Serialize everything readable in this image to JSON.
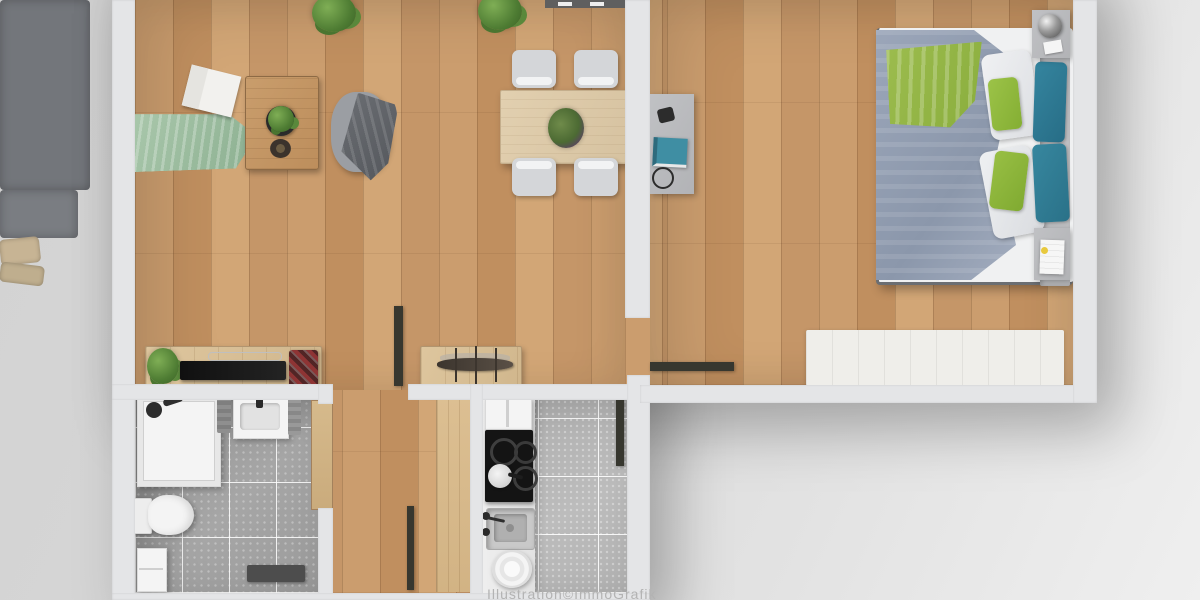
{
  "meta": {
    "kind": "3d-floor-plan-rendering",
    "view": "top-down",
    "watermark_visible": true
  },
  "watermark": {
    "text": "Illustration©ImmoGrafik"
  },
  "palette": {
    "background": "#d6d6d6",
    "wall": "#e4e5e7",
    "wood_floor": "#c59768",
    "bath_tile": "#9b9b9b",
    "kitchen_tile": "#b5b5b5",
    "sofa_gray": "#73767b",
    "blanket_sage": "#9dbfa0",
    "pillow_beige": "#c7b494",
    "duvet_blue_gray": "#98a3b6",
    "bed_green": "#93bf40",
    "bed_teal": "#2e7b96",
    "plant_green": "#4e7c33",
    "door_leaf_dark": "#37372f",
    "tv_black": "#161616",
    "accent_red": "#8e3434"
  },
  "rooms": [
    {
      "name": "living-dining-room",
      "floor": "oak-plank"
    },
    {
      "name": "bedroom",
      "floor": "oak-plank"
    },
    {
      "name": "hallway",
      "floor": "oak-plank"
    },
    {
      "name": "bathroom",
      "floor": "gray-speckled-tile"
    },
    {
      "name": "kitchen",
      "floor": "gray-tile"
    }
  ],
  "furniture": {
    "living_dining": [
      "corner-sofa",
      "beige-pillows",
      "sage-blanket",
      "open-magazine",
      "coffee-table",
      "potted-plant-on-table",
      "decor-bowl",
      "beanbag-with-throw",
      "dining-table",
      "dining-chairs-x4",
      "table-centerpiece",
      "tv-sideboard",
      "flat-tv",
      "red-decor-object",
      "ship-model-sideboard",
      "top-sideboard",
      "floor-plants-x2"
    ],
    "bedroom": [
      "double-bed",
      "gray-blue-duvet",
      "green-folded-blanket",
      "white-pillows-x2",
      "green-pillows-x2",
      "teal-pillows-x2",
      "headboard",
      "nightstand-with-sphere-lamp",
      "nightstand-with-notepad",
      "wall-desk",
      "teal-book",
      "glasses",
      "white-rug"
    ],
    "bathroom": [
      "shower-tray",
      "shower-fixtures",
      "washbasin",
      "towels-x2",
      "toilet",
      "storage-shelf",
      "dark-bath-mat"
    ],
    "kitchen": [
      "counter",
      "wall-shelf",
      "cooktop-4-burners",
      "pan-on-burner",
      "sink-with-faucet",
      "plate-stack"
    ],
    "doors": [
      "open-door-living",
      "open-door-hall",
      "open-door-bath",
      "open-door-kitchen",
      "open-door-bedroom"
    ]
  }
}
